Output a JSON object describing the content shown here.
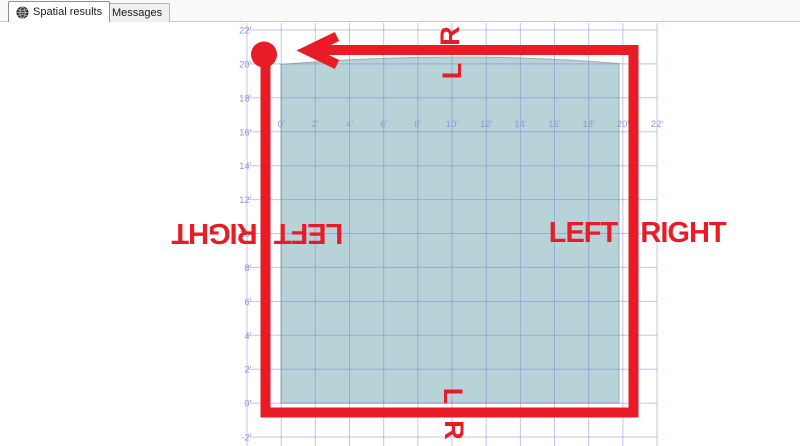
{
  "tab_bar": {
    "tabs": [
      {
        "label": "Spatial results",
        "icon": "globe-icon",
        "active": true
      },
      {
        "label": "Messages",
        "icon": "messages-icon",
        "active": false
      }
    ]
  },
  "chart_data": {
    "type": "spatial-plot",
    "x_axis": {
      "tick_labels": [
        "0'",
        "2'",
        "4'",
        "6'",
        "8'",
        "10'",
        "12'",
        "14'",
        "16'",
        "18'",
        "20'",
        "22'"
      ]
    },
    "y_axis": {
      "tick_labels": [
        "22'",
        "20'",
        "18'",
        "16'",
        "14'",
        "12'",
        "10'",
        "8'",
        "6'",
        "4'",
        "2'",
        "0'",
        "-2'"
      ]
    },
    "grid": true,
    "shape": {
      "type": "polygon",
      "x_range_ft": [
        0,
        20
      ],
      "y_range_ft": [
        0,
        20
      ]
    },
    "colors": {
      "shape_fill": "#b7d3d8",
      "shape_stroke": "#a5abae",
      "grid_line": "rgba(106,116,212,0.42)",
      "axis_text": "#8f96d8",
      "annotation": "#e81b27"
    }
  },
  "annotations": {
    "route": {
      "start_marker": "dot",
      "arrow_direction": "left"
    },
    "labels": {
      "top_above_line": "R",
      "top_below_line": "L",
      "bottom_above_line": "L",
      "bottom_below_line": "R",
      "left_outside": "RIGHT",
      "left_inside": "LEFT",
      "right_inside": "LEFT",
      "right_outside": "RIGHT"
    }
  }
}
